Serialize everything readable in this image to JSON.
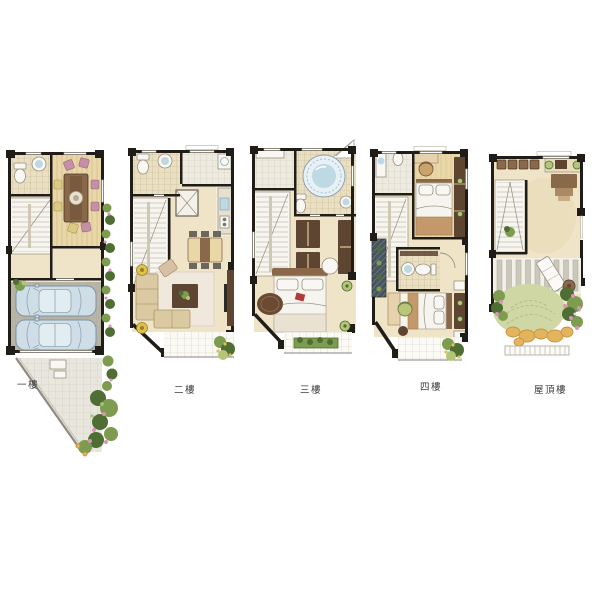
{
  "palette": {
    "page_bg": "#ffffff",
    "wall": "#201d19",
    "label": "#3c3c3c",
    "floor_tan": "#f0e4c8",
    "wood": "#e9d7a8",
    "tile_warm": "#eadfc0",
    "tile_cool": "#edebdf",
    "garage": "#b8b4a8",
    "pave": "#e8e6dd",
    "car_body": "#cfdde6",
    "car_glass": "#e2edf2",
    "fixture": "#f8f7f3",
    "water": "#bed8e4",
    "furn_dark": "#5e4531",
    "furn_mid": "#8a684a",
    "furn_light": "#cbaa7e",
    "sofa": "#dbc9a2",
    "chair_pink": "#c490a6",
    "chair_yellow": "#ddca82",
    "accent_red": "#b13b3b",
    "leaf_dark": "#4e6e34",
    "leaf_mid": "#7d9c50",
    "leaf_light": "#b3c578",
    "lawn": "#cfd8a4",
    "flower_pink": "#d795b8",
    "stone_yellow": "#e2b45e",
    "stone_orange": "#cf9140",
    "deck_slat": "#cbc8ba"
  },
  "plans": [
    {
      "id": "floor-1",
      "label": "一樓"
    },
    {
      "id": "floor-2",
      "label": "二樓"
    },
    {
      "id": "floor-3",
      "label": "三樓"
    },
    {
      "id": "floor-4",
      "label": "四樓"
    },
    {
      "id": "floor-roof",
      "label": "屋頂樓"
    }
  ]
}
